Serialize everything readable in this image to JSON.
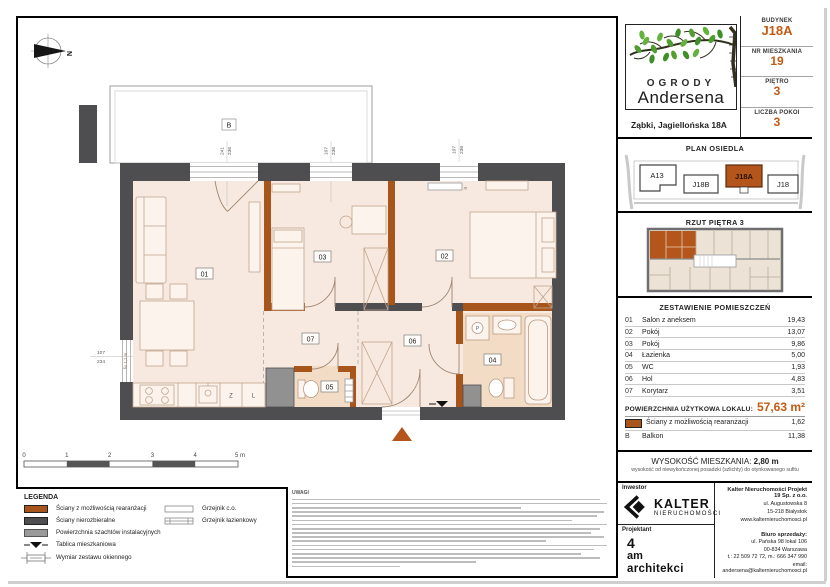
{
  "accent": "#c35a13",
  "header": {
    "logo_line1": "OGRODY",
    "logo_line2": "Andersena",
    "address": "Ząbki, Jagiellońska 18A",
    "fields": [
      {
        "label": "BUDYNEK",
        "value": "J18A"
      },
      {
        "label": "NR MIESZKANIA",
        "value": "19"
      },
      {
        "label": "PIĘTRO",
        "value": "3"
      },
      {
        "label": "LICZBA POKOI",
        "value": "3"
      }
    ]
  },
  "site_plan": {
    "title": "PLAN OSIEDLA",
    "buildings": [
      {
        "label": "A13"
      },
      {
        "label": "J18B"
      },
      {
        "label": "J18A"
      },
      {
        "label": "J18"
      }
    ]
  },
  "floor_overview": {
    "title": "RZUT PIĘTRA 3"
  },
  "rooms_table": {
    "title": "ZESTAWIENIE POMIESZCZEŃ",
    "rows": [
      {
        "no": "01",
        "name": "Salon z aneksem",
        "area": "19,43"
      },
      {
        "no": "02",
        "name": "Pokój",
        "area": "13,07"
      },
      {
        "no": "03",
        "name": "Pokój",
        "area": "9,86"
      },
      {
        "no": "04",
        "name": "Łazienka",
        "area": "5,00"
      },
      {
        "no": "05",
        "name": "WC",
        "area": "1,93"
      },
      {
        "no": "06",
        "name": "Hol",
        "area": "4,83"
      },
      {
        "no": "07",
        "name": "Korytarz",
        "area": "3,51"
      }
    ],
    "total_label": "POWIERZCHNIA UŻYTKOWA LOKALU:",
    "total_value": "57,63 m²",
    "walls_row": {
      "name": "Ściany z możliwością rearanżacji",
      "area": "1,62"
    },
    "balcony_row": {
      "no": "B",
      "name": "Balkon",
      "area": "11,38"
    }
  },
  "height_info": {
    "label": "WYSOKOŚĆ MIESZKANIA:",
    "value": "2,80 m",
    "note": "wysokość od niewykończonej posadzki (szlichty) do otynkowanego sufitu"
  },
  "footer": {
    "investor_label": "Inwestor",
    "brand": "KALTER",
    "brand_sub": "NIERUCHOMOŚCI",
    "company_name": "Kalter Nieruchomości Projekt 19 Sp. z o.o.",
    "company_lines": [
      "ul. Augustowska 8",
      "15-218 Białystok",
      "www.kalternieruchomosci.pl"
    ],
    "designer_label": "Projektant",
    "designer": [
      "4",
      "am",
      "architekci"
    ],
    "sales_label": "Biuro sprzedaży:",
    "sales_lines": [
      "ul. Pańska 98 lokal 106",
      "00-834 Warszawa",
      "t.: 22 509 72 72, m.: 666 347 990",
      "email: andersena@kalternieruchomosci.pl"
    ]
  },
  "legend": {
    "title": "LEGENDA",
    "items": [
      "Ściany z możliwością rearanżacji",
      "Ściany nierozbieralne",
      "Powierzchnia szachtów instalacyjnych",
      "Tablica mieszkaniowa",
      "Wymiar zestawu okiennego"
    ],
    "items2": [
      "Grzejnik c.o.",
      "Grzejnik łazienkowy"
    ]
  },
  "scalebar": {
    "labels": [
      "0",
      "1",
      "2",
      "3",
      "4",
      "5 m"
    ]
  },
  "notes_title": "UWAGI",
  "compass_n": "N",
  "plan": {
    "balcony": "B",
    "labels": {
      "r01": "01",
      "r02": "02",
      "r03": "03",
      "r04": "04",
      "r05": "05",
      "r06": "06",
      "r07": "07",
      "z": "Z",
      "l": "L",
      "p": "P"
    },
    "dims": {
      "w1a": "241",
      "w1b": "236",
      "w2a": "107",
      "w2b": "236",
      "w3a": "107",
      "w3b": "236",
      "w4a": "107",
      "w4b": "234",
      "fix": "fix 1,1 m"
    }
  }
}
